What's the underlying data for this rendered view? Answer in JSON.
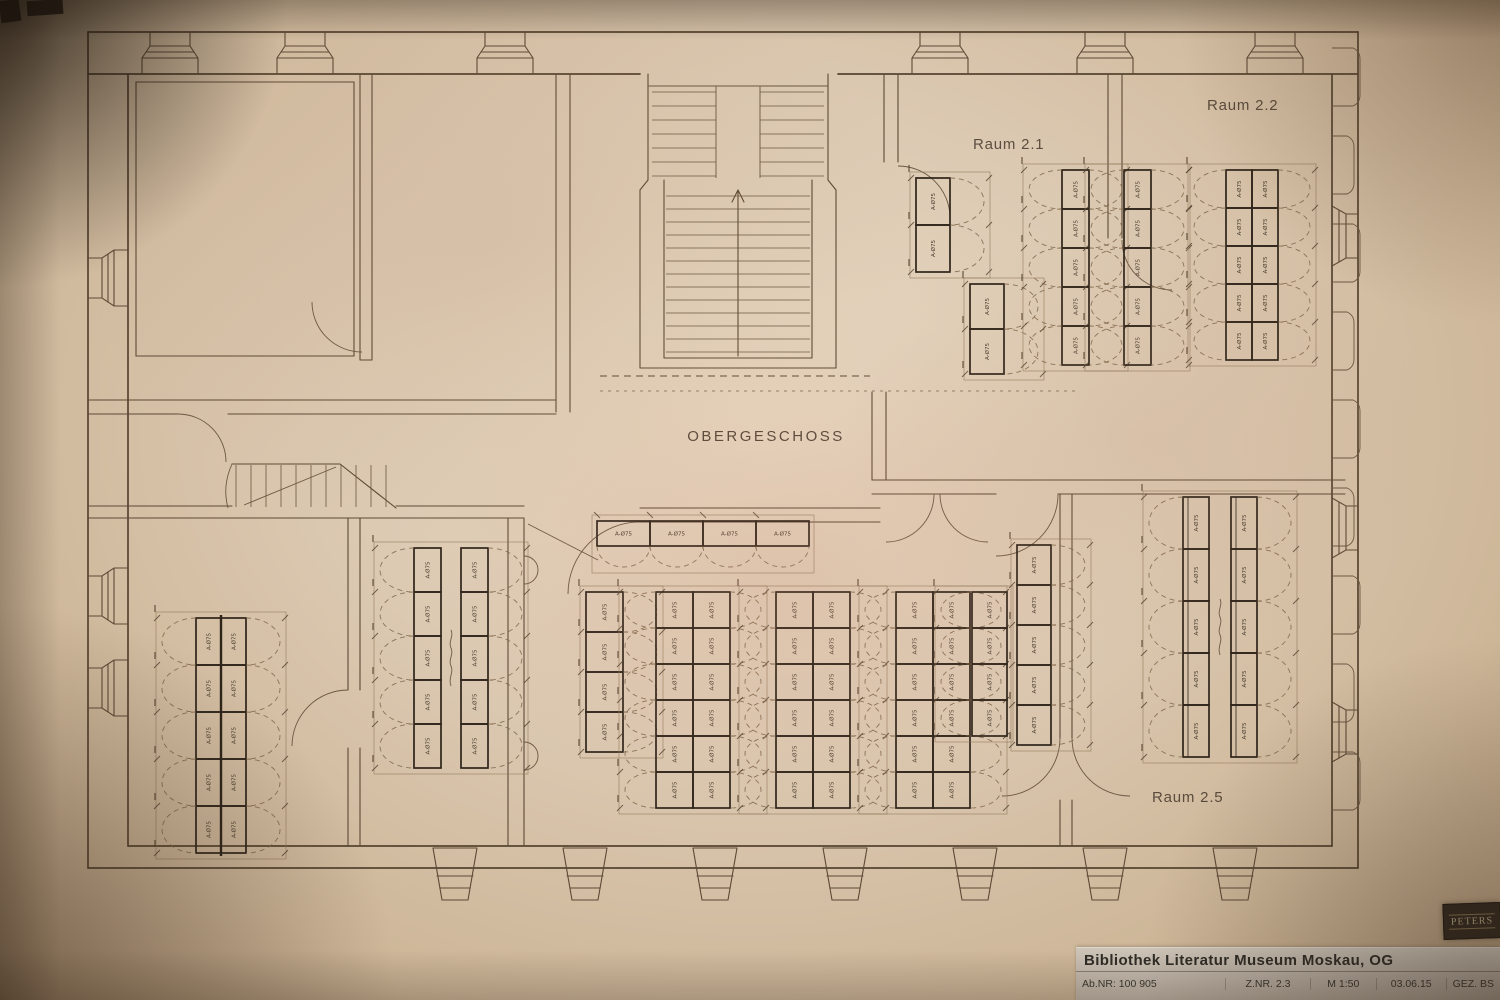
{
  "plan": {
    "floor_label": "OBERGESCHOSS",
    "rooms": [
      {
        "name": "Raum 2.1"
      },
      {
        "name": "Raum 2.2"
      },
      {
        "name": "Raum 2.5"
      }
    ],
    "shelf_label": "A-Ø75",
    "shelf_groups": [
      {
        "id": "r21-a",
        "x": 916,
        "y": 178,
        "cols": 1,
        "uw": 34,
        "uh": 47,
        "units": 2,
        "arcs": "right"
      },
      {
        "id": "r21-b",
        "x": 970,
        "y": 284,
        "cols": 1,
        "uw": 34,
        "uh": 45,
        "units": 2,
        "arcs": "right"
      },
      {
        "id": "r21-c",
        "x": 1062,
        "y": 170,
        "cols": 1,
        "uw": 27,
        "uh": 39,
        "units": 5,
        "arcs": "both"
      },
      {
        "id": "r21-d",
        "x": 1124,
        "y": 170,
        "cols": 1,
        "uw": 27,
        "uh": 39,
        "units": 5,
        "arcs": "both"
      },
      {
        "id": "r22",
        "x": 1226,
        "y": 170,
        "cols": 2,
        "uw": 26,
        "uh": 38,
        "units": 5,
        "arcs": "both"
      },
      {
        "id": "hall-top",
        "x": 597,
        "y": 521,
        "orient": "h",
        "uw": 53,
        "uh": 25,
        "units": 4,
        "arcs": "below"
      },
      {
        "id": "hall-v1",
        "x": 586,
        "y": 592,
        "cols": 1,
        "uw": 37,
        "uh": 40,
        "units": 4,
        "arcs": "right"
      },
      {
        "id": "hall-v2",
        "x": 656,
        "y": 592,
        "cols": 2,
        "uw": 37,
        "uh": 36,
        "units": 6,
        "arcs": "both"
      },
      {
        "id": "hall-v3",
        "x": 776,
        "y": 592,
        "cols": 2,
        "uw": 37,
        "uh": 36,
        "units": 6,
        "arcs": "both"
      },
      {
        "id": "hall-v4",
        "x": 896,
        "y": 592,
        "cols": 2,
        "uw": 37,
        "uh": 36,
        "units": 6,
        "arcs": "both"
      },
      {
        "id": "hall-v5",
        "x": 972,
        "y": 592,
        "cols": 1,
        "uw": 35,
        "uh": 36,
        "units": 4,
        "arcs": "left"
      },
      {
        "id": "hall-v6",
        "x": 1017,
        "y": 545,
        "cols": 1,
        "uw": 34,
        "uh": 40,
        "units": 5,
        "arcs": "right"
      },
      {
        "id": "room-bl",
        "x": 196,
        "y": 618,
        "cols": 2,
        "uw": 25,
        "uh": 47,
        "units": 5,
        "arcs": "both",
        "spine": true
      },
      {
        "id": "room-ml",
        "x": 414,
        "y": 548,
        "cols": 2,
        "uw": 27,
        "uh": 44,
        "units": 5,
        "arcs": "both",
        "gap": 20,
        "word": true
      },
      {
        "id": "r25",
        "x": 1183,
        "y": 497,
        "cols": 2,
        "uw": 26,
        "uh": 52,
        "units": 5,
        "arcs": "both",
        "gap": 22,
        "word": true,
        "dbl": true
      }
    ]
  },
  "title_block": {
    "title": "Bibliothek Literatur Museum Moskau, OG",
    "fields": [
      "Ab.NR: 100 905",
      "Z.NR. 2.3",
      "M 1:50",
      "03.06.15",
      "GEZ. BS"
    ]
  },
  "stamp": {
    "text": "PETERS"
  },
  "colors": {
    "paper": "#d8c5ae",
    "ink": "#5a4733",
    "shelf_ink": "#2e241a",
    "title_strip": "#c8bfb3",
    "stamp_bg": "#32281e"
  }
}
